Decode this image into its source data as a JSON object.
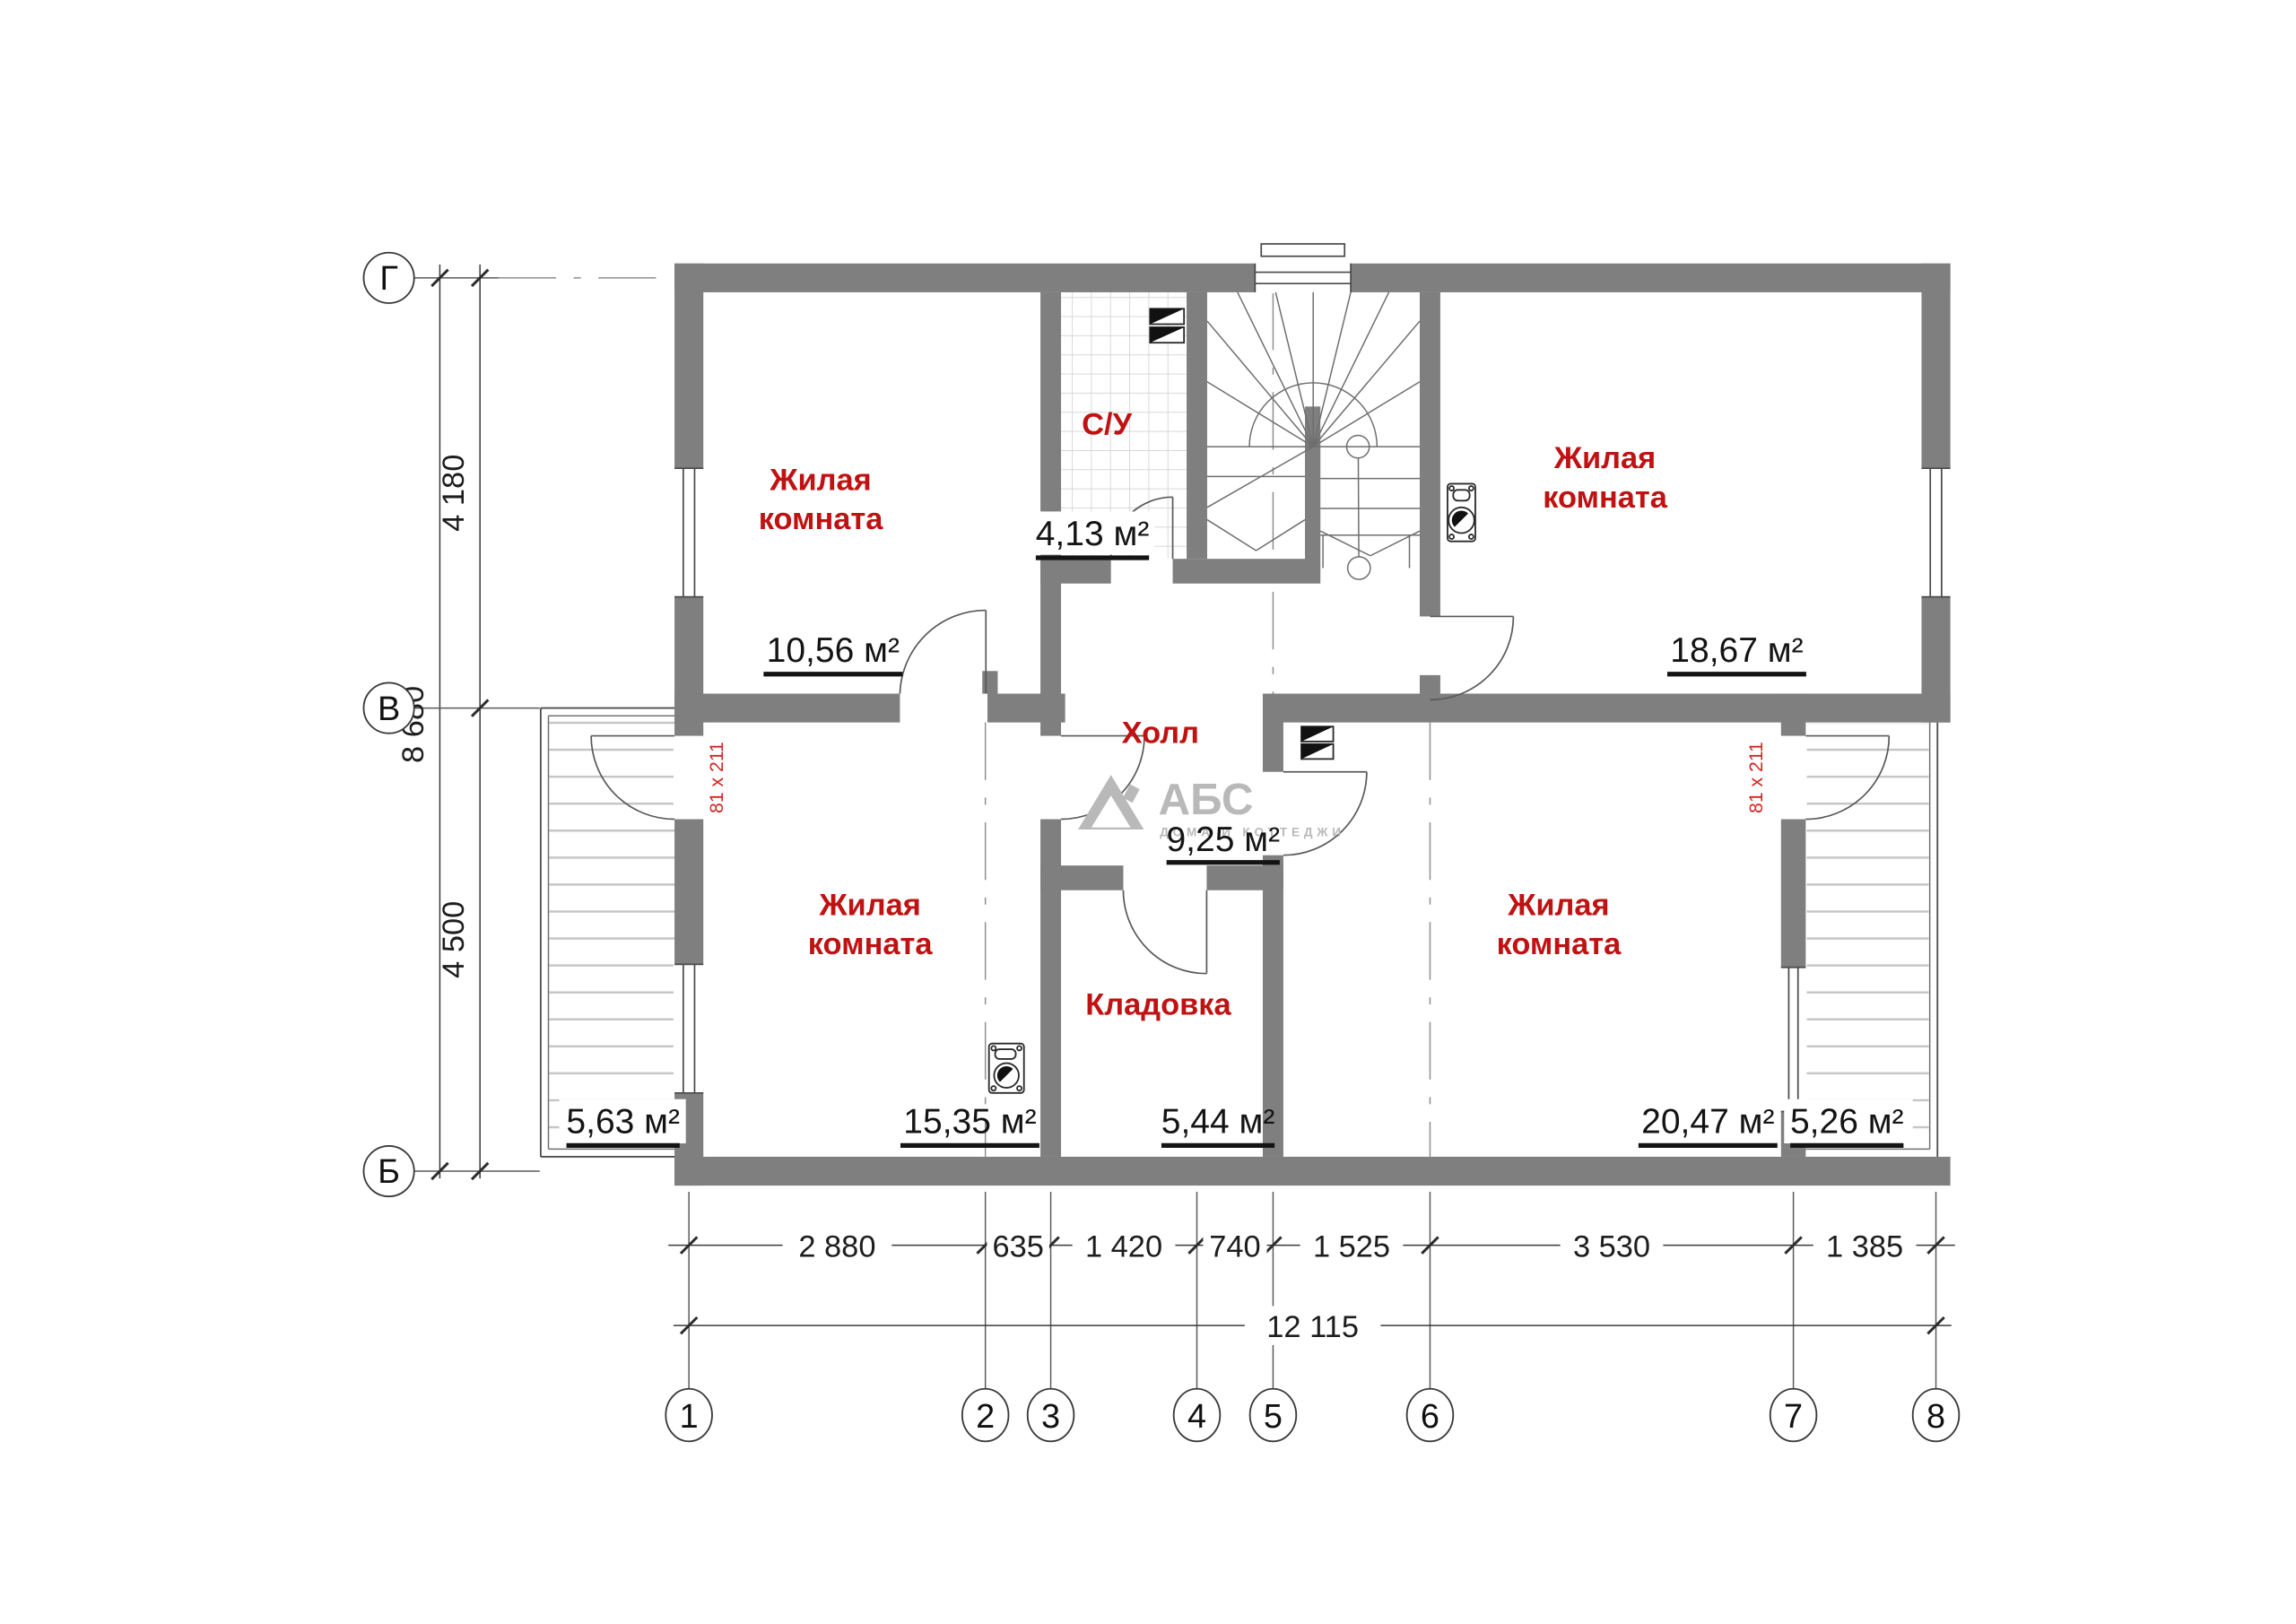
{
  "plan": {
    "rooms": [
      {
        "name_lines": [
          "Жилая",
          "комната"
        ],
        "area": "10,56 м²"
      },
      {
        "name": "С/У",
        "area": "4,13 м²"
      },
      {
        "name_lines": [
          "Жилая",
          "комната"
        ],
        "area": "18,67 м²"
      },
      {
        "name": "Холл",
        "area": "9,25 м²"
      },
      {
        "name_lines": [
          "Жилая",
          "комната"
        ],
        "area": "15,35 м²"
      },
      {
        "name": "Кладовка",
        "area": "5,44 м²"
      },
      {
        "name_lines": [
          "Жилая",
          "комната"
        ],
        "area": "20,47 м²"
      }
    ],
    "balconies": {
      "left_area": "5,63 м²",
      "right_area": "5,26 м²"
    },
    "door_size_label": "81 x 211"
  },
  "axes": {
    "vertical": [
      "Г",
      "В",
      "Б"
    ],
    "horizontal": [
      "1",
      "2",
      "3",
      "4",
      "5",
      "6",
      "7",
      "8"
    ]
  },
  "dimensions": {
    "left_spans": [
      "4 180",
      "4 500"
    ],
    "left_total": "8 680",
    "bottom_spans": [
      "2 880",
      "635",
      "1 420",
      "740",
      "1 525",
      "3 530",
      "1 385"
    ],
    "bottom_total": "12 115"
  },
  "watermark": {
    "brand": "АБС",
    "tagline": "ДОМА И КОТТЕДЖИ"
  }
}
